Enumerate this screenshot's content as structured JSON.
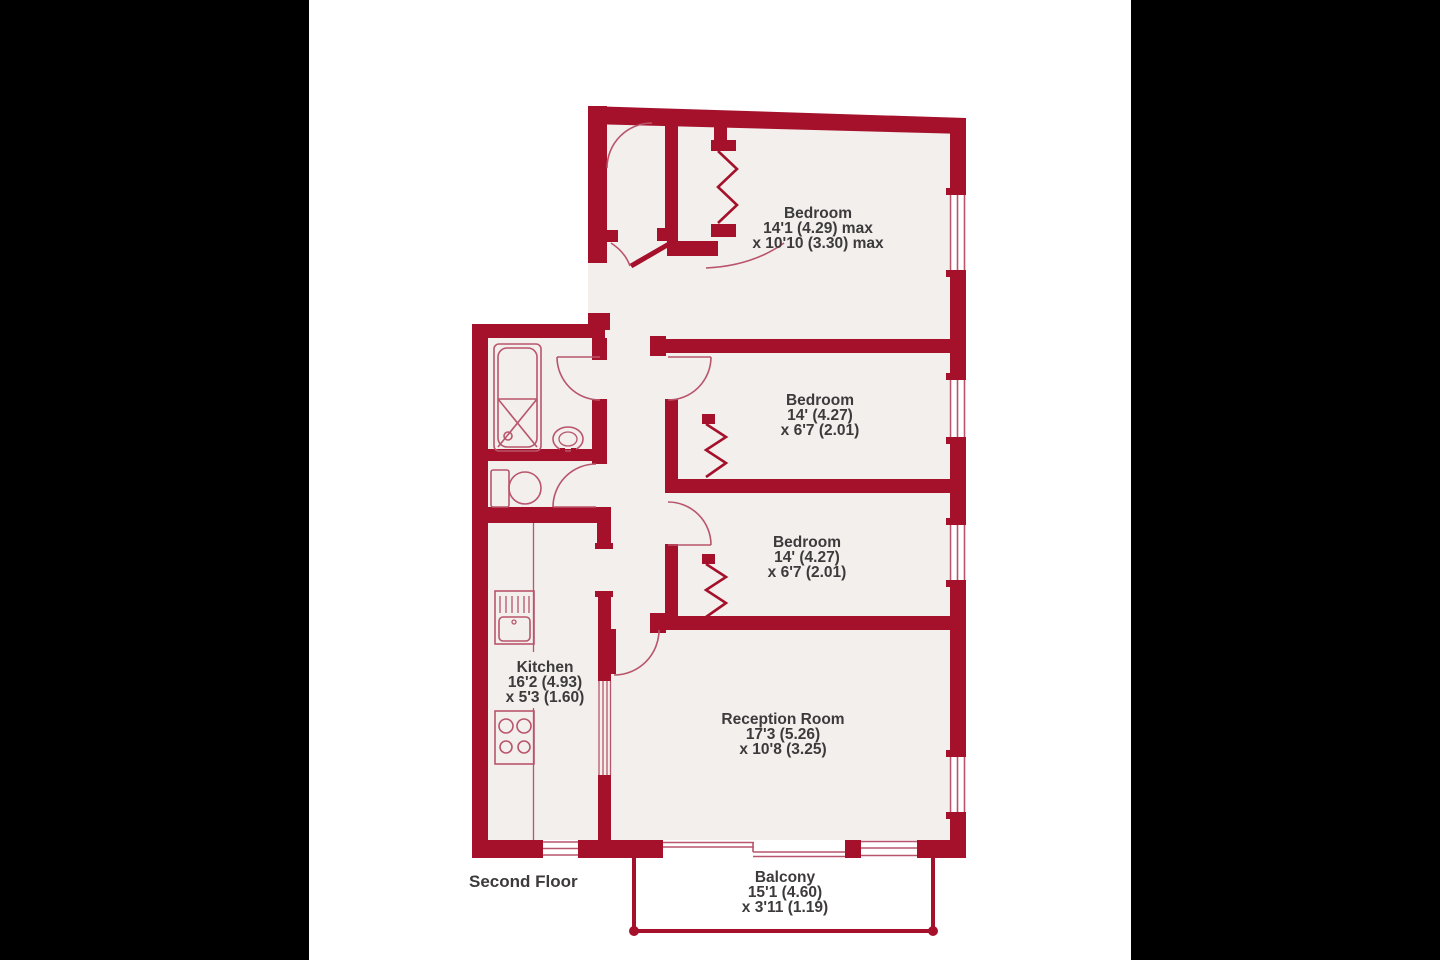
{
  "palette": {
    "wall_red": "#a5112b",
    "fixture_line_red": "#b9556b",
    "floor_fill": "#f2efed",
    "label_text": "#3d3a3b",
    "paper": "#ffffff",
    "side_bars": "#000000"
  },
  "floor_label": "Second Floor",
  "rooms": {
    "bedroom1": {
      "name": "Bedroom",
      "dim1": "14'1 (4.29) max",
      "dim2": "x 10'10 (3.30) max"
    },
    "bedroom2": {
      "name": "Bedroom",
      "dim1": "14' (4.27)",
      "dim2": "x 6'7 (2.01)"
    },
    "bedroom3": {
      "name": "Bedroom",
      "dim1": "14' (4.27)",
      "dim2": "x 6'7 (2.01)"
    },
    "reception": {
      "name": "Reception Room",
      "dim1": "17'3 (5.26)",
      "dim2": "x 10'8 (3.25)"
    },
    "kitchen": {
      "name": "Kitchen",
      "dim1": "16'2 (4.93)",
      "dim2": "x 5'3 (1.60)"
    },
    "balcony": {
      "name": "Balcony",
      "dim1": "15'1 (4.60)",
      "dim2": "x 3'11 (1.19)"
    }
  },
  "fixtures": [
    "bathtub",
    "wash-basin",
    "toilet",
    "kitchen-sink",
    "hob",
    "kitchen-counter",
    "wardrobe-bifold-doors",
    "windows",
    "door-swings",
    "balcony-railing"
  ]
}
